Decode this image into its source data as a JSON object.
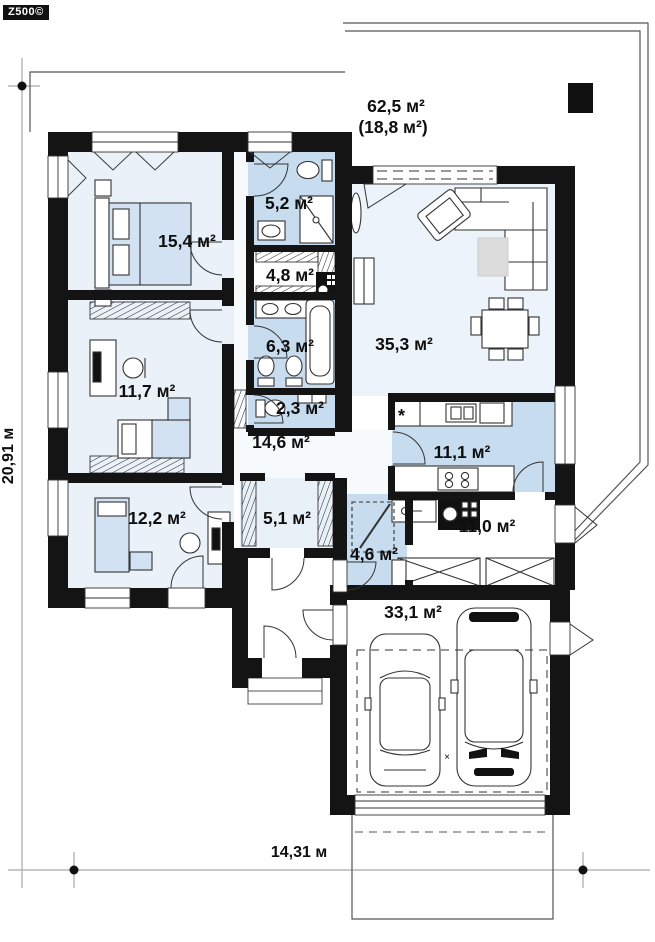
{
  "brand": {
    "logo": "Z500©"
  },
  "plan": {
    "dimensions": {
      "height_total": "20,91 м",
      "width_total": "14,31 м"
    },
    "terrace": {
      "area_total": "62,5 м²",
      "area_covered": "(18,8 м²)"
    },
    "rooms": {
      "bathroom_small": {
        "area": "5,2 м²"
      },
      "bedroom_master": {
        "area": "15,4 м²"
      },
      "wardrobe": {
        "area": "4,8 м²"
      },
      "bathroom_main": {
        "area": "6,3 м²"
      },
      "living_room": {
        "area": "35,3 м²"
      },
      "bedroom_second": {
        "area": "11,7 м²"
      },
      "wc": {
        "area": "2,3 м²"
      },
      "hall": {
        "area": "14,6 м²"
      },
      "kitchen": {
        "area": "11,1 м²"
      },
      "bedroom_third": {
        "area": "12,2 м²"
      },
      "corridor": {
        "area": "5,1 м²"
      },
      "boiler_room": {
        "area": "4,6 м²"
      },
      "utility": {
        "area": "11,0 м²"
      },
      "garage": {
        "area": "33,1 м²"
      }
    },
    "symbols": {
      "fridge": "*",
      "garage_mark": "×"
    },
    "colors": {
      "wall": "#141414",
      "wet_room_fill": "#c7dcef",
      "room_fill": "#eaf1f8",
      "living_fill": "#edf3fa",
      "hall_fill": "#f7fafc",
      "furniture_blue": "#d3e2f2",
      "rug_gray": "#dcdcdc",
      "dimension_line": "#b5b5b5"
    }
  }
}
